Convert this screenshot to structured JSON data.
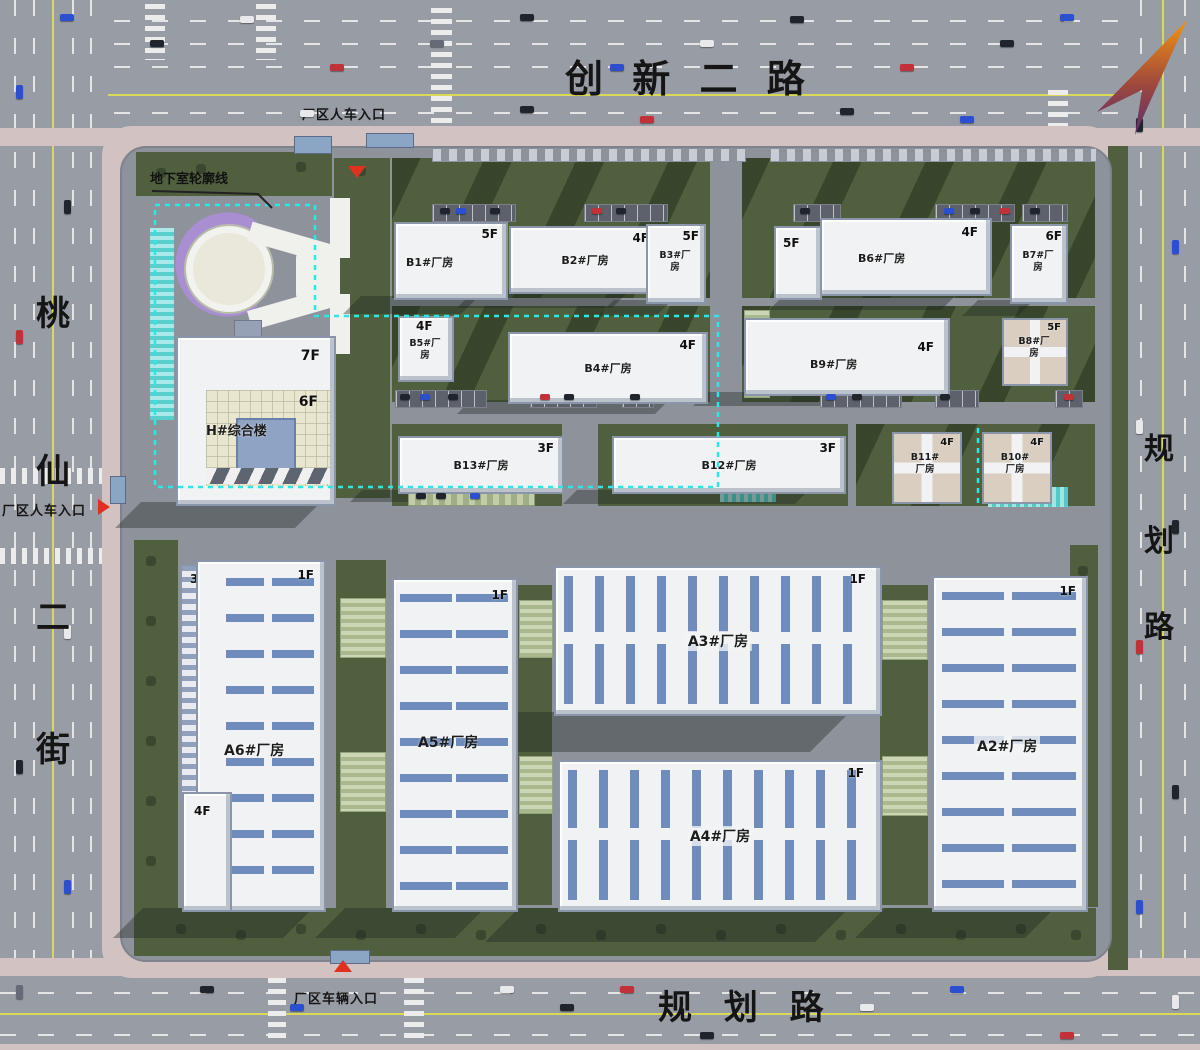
{
  "roads": {
    "top": {
      "label": "创 新 二 路"
    },
    "left": {
      "chars": [
        "桃",
        "仙",
        "二",
        "街"
      ]
    },
    "right": {
      "chars": [
        "规",
        "划",
        "路"
      ]
    },
    "bottom": {
      "label": "规 划 路"
    }
  },
  "entrances": {
    "top": {
      "label": "厂区人车入口"
    },
    "left": {
      "label": "厂区人车入口"
    },
    "bottom": {
      "label": "厂区车辆入口"
    }
  },
  "annotations": {
    "basement_outline": {
      "label": "地下室轮廓线"
    }
  },
  "buildings": {
    "b1": {
      "label": "B1#厂房",
      "floors": "5F"
    },
    "b2": {
      "label": "B2#厂房",
      "floors": "4F"
    },
    "b3": {
      "label": "B3#厂房",
      "floors": "5F"
    },
    "b5_annex": {
      "floors": "5F"
    },
    "b6": {
      "label": "B6#厂房",
      "floors": "4F"
    },
    "b7": {
      "label": "B7#厂房",
      "floors": "6F"
    },
    "b5": {
      "label": "B5#厂房",
      "floors": "4F"
    },
    "b4": {
      "label": "B4#厂房",
      "floors": "4F"
    },
    "b9": {
      "label": "B9#厂房",
      "floors": "4F"
    },
    "b8": {
      "label": "B8#厂房",
      "floors": "5F"
    },
    "b13": {
      "label": "B13#厂房",
      "floors": "3F"
    },
    "b12": {
      "label": "B12#厂房",
      "floors": "3F"
    },
    "b11": {
      "label": "B11#厂房",
      "floors": "4F"
    },
    "b10": {
      "label": "B10#厂房",
      "floors": "4F"
    },
    "h": {
      "label": "H#综合楼",
      "floors_upper": "7F",
      "floors_lower": "6F"
    },
    "a6": {
      "label": "A6#厂房",
      "floors_main": "1F",
      "floors_annex_top": "3F",
      "floors_annex_bottom": "4F"
    },
    "a5": {
      "label": "A5#厂房",
      "floors": "1F"
    },
    "a3": {
      "label": "A3#厂房",
      "floors": "1F"
    },
    "a4": {
      "label": "A4#厂房",
      "floors": "1F"
    },
    "a2": {
      "label": "A2#厂房",
      "floors": "1F"
    }
  },
  "colors": {
    "road": "#989ca4",
    "site": "#8e929b",
    "green": "#50603e",
    "sidewalk": "#d2c3c2",
    "building": "#f1f2f4",
    "stripe_blue": "#6f8cbc",
    "basement_line": "#2ae8e8",
    "entrance_red": "#e03020",
    "north_arrow_top": "#f5930f",
    "north_arrow_bottom": "#5c2a6e"
  }
}
